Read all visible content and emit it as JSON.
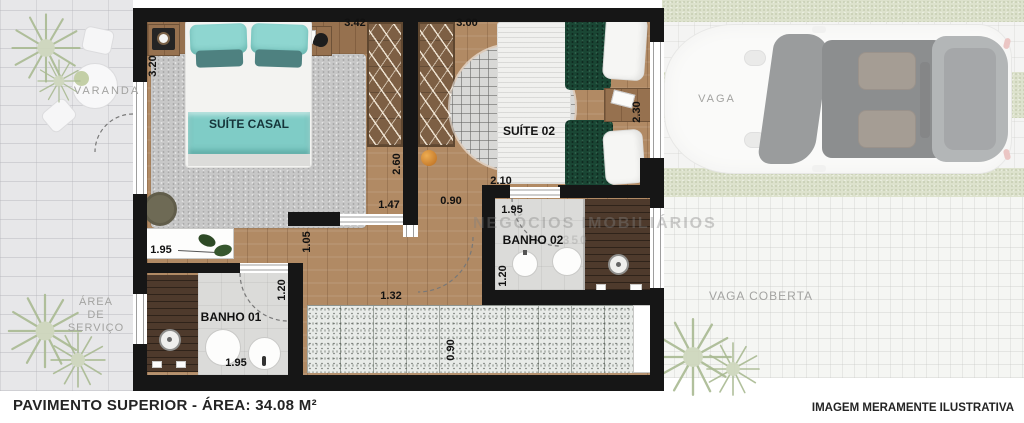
{
  "footer": {
    "left": "PAVIMENTO SUPERIOR - ÁREA: 34.08 M²",
    "right": "IMAGEM MERAMENTE ILUSTRATIVA"
  },
  "watermark": {
    "line1": "NEGÓCIOS IMOBILIÁRIOS",
    "line2": "33 3350"
  },
  "rooms": {
    "varanda": "VARANDA",
    "area_servico_l1": "ÁREA",
    "area_servico_l2": "DE",
    "area_servico_l3": "SERVIÇO",
    "suite_casal": "SUÍTE CASAL",
    "suite_02": "SUÍTE 02",
    "banho_01": "BANHO 01",
    "banho_02": "BANHO 02",
    "vaga": "VAGA",
    "vaga_coberta": "VAGA COBERTA"
  },
  "dims": {
    "suite_casal_width": "3.42",
    "suite_casal_depth": "3.20",
    "suite_02_width": "3.00",
    "suite_02_depth": "2.30",
    "closet_length": "2.60",
    "hall_upper": "1.47",
    "hall_door": "0.90",
    "suite_02_corridor": "2.10",
    "banho_02_width": "1.95",
    "banho_02_depth": "1.20",
    "console_length": "1.95",
    "passage": "1.05",
    "hall_lower": "1.32",
    "banho_01_depth": "1.20",
    "banho_01_width": "1.95",
    "stairs_width": "0.90"
  },
  "colors": {
    "wall": "#161616",
    "wood_floor": "#b18a64",
    "closet_wood": "#7d5f44",
    "shower_wood": "#4e3a2c",
    "rug_gray": "#c7c7c7",
    "pillow_teal_light": "#8ed6d0",
    "pillow_teal_dark": "#4e8180",
    "runner_teal": "#7fccc6",
    "bed_green": "#1a4634",
    "bath_floor": "#dbdbd9",
    "stairs_terrazzo": "#e8ebe8",
    "grass": "#c8d1ae",
    "outdoor_pavers": "#e7e7e9"
  }
}
